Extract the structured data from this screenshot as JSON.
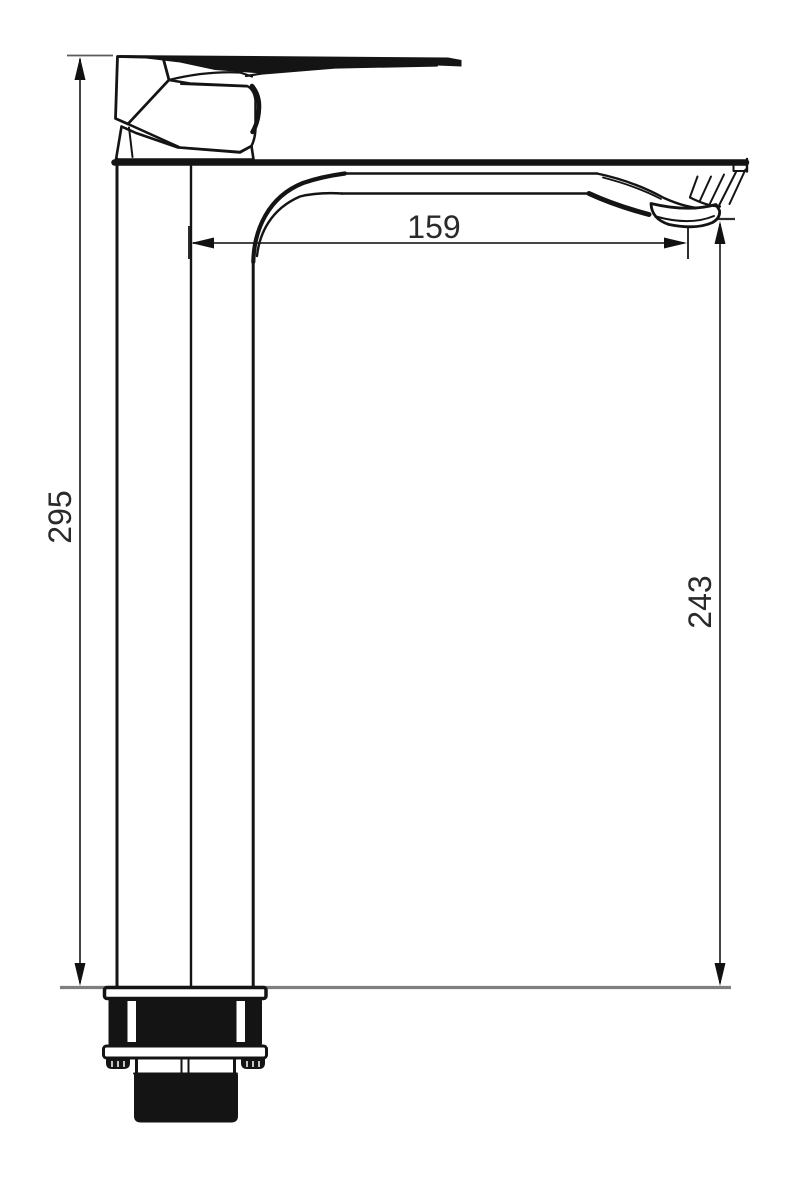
{
  "drawing": {
    "description": "Technical line drawing: side elevation of a tall single-lever basin mixer faucet with mounting shank, annotated with three dimensions",
    "background_color": "#ffffff",
    "line_color": "#141414",
    "dimension_line_color": "#454545",
    "mounting_surface_line_color": "#7f7f7f",
    "text_color": "#2a2a2a",
    "dims": {
      "total_height": {
        "value": "295",
        "orientation": "vertical-left"
      },
      "spout_reach": {
        "value": "159",
        "orientation": "horizontal-top"
      },
      "outlet_height": {
        "value": "243",
        "orientation": "vertical-right"
      }
    }
  }
}
